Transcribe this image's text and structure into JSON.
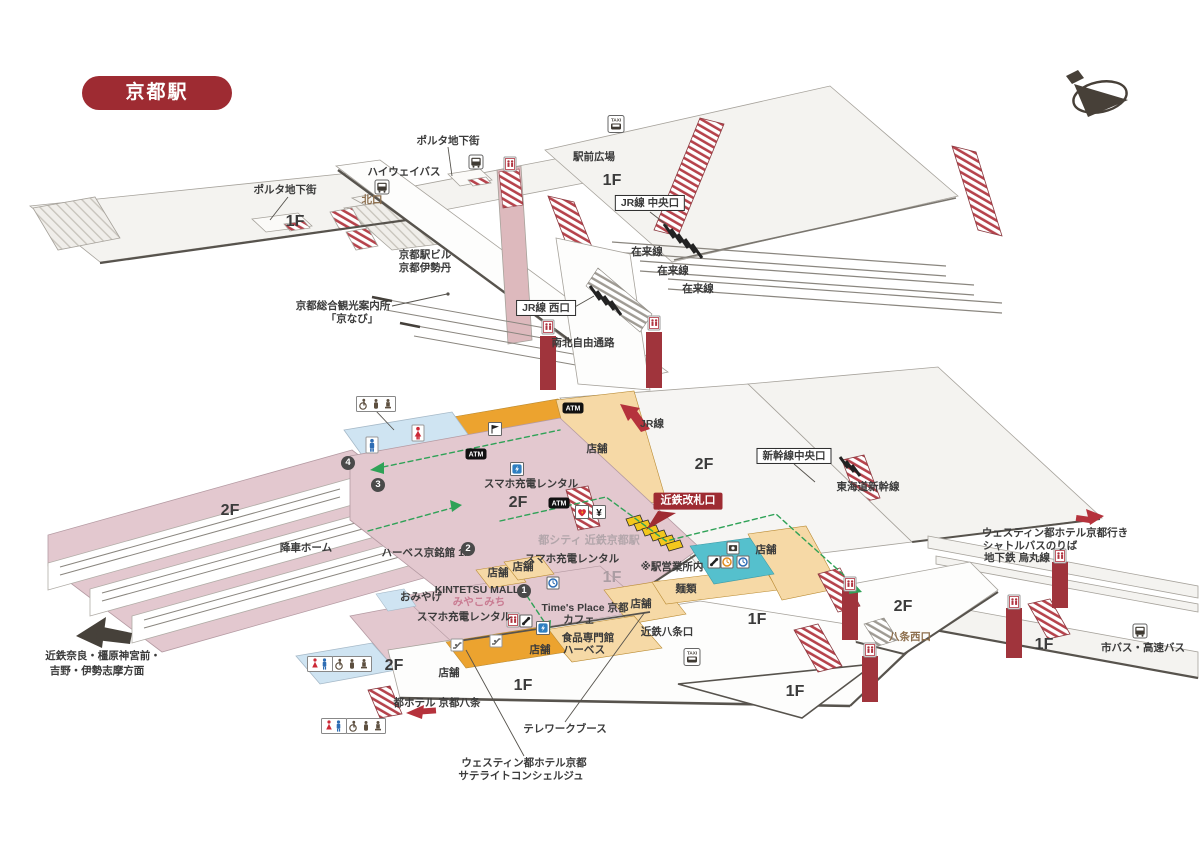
{
  "title_badge": {
    "text": "京都駅"
  },
  "colors": {
    "red": "#9e2b32",
    "pink": "#e3c8cf",
    "orange": "#eca32f",
    "orange_light": "#f6d9a6",
    "blue": "#cfe4f2",
    "teal": "#55c0cd",
    "green": "#2fa257",
    "floor": "#f4f3f0",
    "brown": "#8d6f4e",
    "gray_text": "#b3a6ab",
    "ink": "#3b3b3b"
  },
  "labels": [
    {
      "name": "porta-chikagai-top",
      "text": "ポルタ地下街",
      "x": 448,
      "y": 141,
      "cls": "s"
    },
    {
      "name": "highway-bus",
      "text": "ハイウェイバス",
      "x": 404,
      "y": 172,
      "cls": "s"
    },
    {
      "name": "ekimae-hiroba",
      "text": "駅前広場",
      "x": 594,
      "y": 157,
      "cls": "s"
    },
    {
      "name": "floor-1f-plaza",
      "text": "1F",
      "x": 612,
      "y": 181,
      "cls": "floor"
    },
    {
      "name": "jr-central-exit",
      "text": "JR線 中央口",
      "x": 650,
      "y": 203,
      "cls": "box"
    },
    {
      "name": "kitaguchi",
      "text": "北口",
      "x": 372,
      "y": 200,
      "cls": "brown"
    },
    {
      "name": "porta-chikagai-left",
      "text": "ポルタ地下街",
      "x": 285,
      "y": 190,
      "cls": "s"
    },
    {
      "name": "floor-1f-west",
      "text": "1F",
      "x": 295,
      "y": 222,
      "cls": "floor"
    },
    {
      "name": "kyoto-station-bldg-line1",
      "text": "京都駅ビル",
      "x": 425,
      "y": 255,
      "cls": "s"
    },
    {
      "name": "kyoto-station-bldg-line2",
      "text": "京都伊勢丹",
      "x": 425,
      "y": 268,
      "cls": "s"
    },
    {
      "name": "zairaisen-1",
      "text": "在来線",
      "x": 647,
      "y": 252,
      "cls": "s"
    },
    {
      "name": "zairaisen-2",
      "text": "在来線",
      "x": 673,
      "y": 271,
      "cls": "s"
    },
    {
      "name": "zairaisen-3",
      "text": "在来線",
      "x": 698,
      "y": 289,
      "cls": "s"
    },
    {
      "name": "jr-west-exit",
      "text": "JR線 西口",
      "x": 546,
      "y": 308,
      "cls": "box"
    },
    {
      "name": "kyonavi-line1",
      "text": "京都総合観光案内所",
      "x": 343,
      "y": 306,
      "cls": "s"
    },
    {
      "name": "kyonavi-line2",
      "text": "「京なび」",
      "x": 352,
      "y": 319,
      "cls": "s"
    },
    {
      "name": "free-passage",
      "text": "南北自由通路",
      "x": 583,
      "y": 343,
      "cls": "s"
    },
    {
      "name": "jr-line",
      "text": "JR線",
      "x": 652,
      "y": 424,
      "cls": "s"
    },
    {
      "name": "tenpo-2f",
      "text": "店舗",
      "x": 597,
      "y": 449,
      "cls": "s"
    },
    {
      "name": "floor-2f-jr",
      "text": "2F",
      "x": 704,
      "y": 465,
      "cls": "floor"
    },
    {
      "name": "shinkansen-central-exit",
      "text": "新幹線中央口",
      "x": 794,
      "y": 456,
      "cls": "box"
    },
    {
      "name": "tokaido-shinkansen",
      "text": "東海道新幹線",
      "x": 868,
      "y": 487,
      "cls": "s"
    },
    {
      "name": "sumaho-rental-2f",
      "text": "スマホ充電レンタル",
      "x": 531,
      "y": 484,
      "cls": "s"
    },
    {
      "name": "floor-2f-kintetsu",
      "text": "2F",
      "x": 518,
      "y": 503,
      "cls": "floor"
    },
    {
      "name": "kintetsu-gate-badge",
      "text": "近鉄改札口",
      "x": 688,
      "y": 501,
      "cls": "badge-red"
    },
    {
      "name": "miyako-city-kintetsu",
      "text": "都シティ 近鉄京都駅",
      "x": 589,
      "y": 541,
      "cls": "gray"
    },
    {
      "name": "sumaho-rental-1f-a",
      "text": "スマホ充電レンタル",
      "x": 572,
      "y": 559,
      "cls": "s"
    },
    {
      "name": "eki-eigyosho",
      "text": "※駅営業所内",
      "x": 672,
      "y": 567,
      "cls": "s"
    },
    {
      "name": "tenpo-right",
      "text": "店舗",
      "x": 766,
      "y": 550,
      "cls": "s"
    },
    {
      "name": "kosha-home",
      "text": "降車ホーム",
      "x": 306,
      "y": 548,
      "cls": "s"
    },
    {
      "name": "harves-kyomeikan",
      "text": "ハーベス京銘館 1F",
      "x": 426,
      "y": 553,
      "cls": "s"
    },
    {
      "name": "tenpo-a",
      "text": "店舗",
      "x": 498,
      "y": 573,
      "cls": "s"
    },
    {
      "name": "tenpo-b",
      "text": "店舗",
      "x": 523,
      "y": 567,
      "cls": "s"
    },
    {
      "name": "omiyage",
      "text": "おみやげ",
      "x": 421,
      "y": 597,
      "cls": "s"
    },
    {
      "name": "kintetsu-mall",
      "text": "KINTETSU MALL",
      "x": 477,
      "y": 590,
      "cls": "s"
    },
    {
      "name": "miyakomichi",
      "text": "みやこみち",
      "x": 479,
      "y": 602,
      "cls": "pink-t"
    },
    {
      "name": "sumaho-rental-1f-b",
      "text": "スマホ充電レンタル",
      "x": 464,
      "y": 617,
      "cls": "s"
    },
    {
      "name": "times-place-kyoto",
      "text": "Time's Place 京都",
      "x": 585,
      "y": 608,
      "cls": "s"
    },
    {
      "name": "cafe",
      "text": "カフェ",
      "x": 579,
      "y": 620,
      "cls": "s"
    },
    {
      "name": "food-harves-line1",
      "text": "食品専門館",
      "x": 588,
      "y": 638,
      "cls": "s"
    },
    {
      "name": "food-harves-line2",
      "text": "ハーベス",
      "x": 584,
      "y": 650,
      "cls": "s"
    },
    {
      "name": "tenpo-c",
      "text": "店舗",
      "x": 641,
      "y": 604,
      "cls": "s"
    },
    {
      "name": "tenpo-d",
      "text": "店舗",
      "x": 540,
      "y": 650,
      "cls": "s"
    },
    {
      "name": "tenpo-e",
      "text": "店舗",
      "x": 449,
      "y": 673,
      "cls": "s"
    },
    {
      "name": "menrui",
      "text": "麺類",
      "x": 686,
      "y": 589,
      "cls": "s"
    },
    {
      "name": "kintetsu-hachijo-exit",
      "text": "近鉄八条口",
      "x": 667,
      "y": 632,
      "cls": "s"
    },
    {
      "name": "floor-1f-pink",
      "text": "1F",
      "x": 612,
      "y": 578,
      "cls": "floor-gray"
    },
    {
      "name": "floor-1f-hachijo",
      "text": "1F",
      "x": 757,
      "y": 620,
      "cls": "floor"
    },
    {
      "name": "floor-1f-south",
      "text": "1F",
      "x": 523,
      "y": 686,
      "cls": "floor"
    },
    {
      "name": "floor-1f-triangle",
      "text": "1F",
      "x": 795,
      "y": 692,
      "cls": "floor"
    },
    {
      "name": "floor-1f-east",
      "text": "1F",
      "x": 1044,
      "y": 645,
      "cls": "floor"
    },
    {
      "name": "floor-2f-west-end",
      "text": "2F",
      "x": 394,
      "y": 666,
      "cls": "floor"
    },
    {
      "name": "floor-2f-hachijo-west",
      "text": "2F",
      "x": 903,
      "y": 607,
      "cls": "floor"
    },
    {
      "name": "floor-2f-platform",
      "text": "2F",
      "x": 230,
      "y": 511,
      "cls": "floor"
    },
    {
      "name": "hachijo-west-exit",
      "text": "八条西口",
      "x": 910,
      "y": 637,
      "cls": "brown"
    },
    {
      "name": "westin-shuttle-line1",
      "text": "ウェスティン都ホテル京都行き",
      "x": 1055,
      "y": 533,
      "cls": "s"
    },
    {
      "name": "westin-shuttle-line2",
      "text": "シャトルバスのりば",
      "x": 1030,
      "y": 546,
      "cls": "s"
    },
    {
      "name": "westin-shuttle-line3",
      "text": "地下鉄 烏丸線",
      "x": 1017,
      "y": 558,
      "cls": "s"
    },
    {
      "name": "city-bus",
      "text": "市バス・高速バス",
      "x": 1143,
      "y": 648,
      "cls": "s"
    },
    {
      "name": "kintetsu-nara-line1",
      "text": "近鉄奈良・橿原神宮前・",
      "x": 103,
      "y": 656,
      "cls": "s"
    },
    {
      "name": "kintetsu-nara-line2",
      "text": "吉野・伊勢志摩方面",
      "x": 97,
      "y": 671,
      "cls": "s"
    },
    {
      "name": "miyako-hotel-hachijo",
      "text": "都ホテル 京都八条",
      "x": 437,
      "y": 703,
      "cls": "s"
    },
    {
      "name": "telework-booth",
      "text": "テレワークブース",
      "x": 565,
      "y": 729,
      "cls": "s"
    },
    {
      "name": "westin-satellite-line1",
      "text": "ウェスティン都ホテル京都",
      "x": 524,
      "y": 763,
      "cls": "s"
    },
    {
      "name": "westin-satellite-line2",
      "text": "サテライトコンシェルジュ",
      "x": 521,
      "y": 776,
      "cls": "s"
    }
  ],
  "markers": [
    {
      "name": "marker-4",
      "n": "4",
      "x": 348,
      "y": 463
    },
    {
      "name": "marker-3",
      "n": "3",
      "x": 378,
      "y": 485
    },
    {
      "name": "marker-2",
      "n": "2",
      "x": 468,
      "y": 549
    },
    {
      "name": "marker-1",
      "n": "1",
      "x": 524,
      "y": 591
    }
  ],
  "icons": [
    {
      "name": "taxi-icon-north",
      "type": "taxi",
      "x": 616,
      "y": 124
    },
    {
      "name": "taxi-icon-south",
      "type": "taxi",
      "x": 692,
      "y": 657
    },
    {
      "name": "bus-icon-highway",
      "type": "bus",
      "x": 382,
      "y": 187
    },
    {
      "name": "bus-icon-north",
      "type": "bus",
      "x": 476,
      "y": 162
    },
    {
      "name": "bus-icon-city",
      "type": "bus",
      "x": 1140,
      "y": 631
    },
    {
      "name": "atm-icon-a",
      "type": "atm",
      "x": 573,
      "y": 408
    },
    {
      "name": "atm-icon-b",
      "type": "atm",
      "x": 476,
      "y": 454
    },
    {
      "name": "atm-icon-c",
      "type": "atm",
      "x": 559,
      "y": 503
    },
    {
      "name": "meeting-flag-icon",
      "type": "flag",
      "x": 495,
      "y": 429
    },
    {
      "name": "restroom-male-icon",
      "type": "male",
      "x": 372,
      "y": 445
    },
    {
      "name": "restroom-female-icon",
      "type": "female",
      "x": 418,
      "y": 433
    },
    {
      "name": "accessible-restroom-icon-top",
      "type": "rr3",
      "x": 376,
      "y": 404
    },
    {
      "name": "restroom-mf-icon-west",
      "type": "mf",
      "x": 320,
      "y": 664
    },
    {
      "name": "accessible-restroom-icon-west",
      "type": "rr3",
      "x": 352,
      "y": 664
    },
    {
      "name": "restroom-mf-icon-south",
      "type": "mf",
      "x": 334,
      "y": 726
    },
    {
      "name": "accessible-restroom-icon-south",
      "type": "rr3",
      "x": 366,
      "y": 726
    },
    {
      "name": "elevator-icon-bridge",
      "type": "ev",
      "x": 510,
      "y": 164
    },
    {
      "name": "elevator-icon-passage-w",
      "type": "ev",
      "x": 548,
      "y": 327
    },
    {
      "name": "elevator-icon-passage-e",
      "type": "ev",
      "x": 654,
      "y": 323
    },
    {
      "name": "elevator-icon-hachijo-a",
      "type": "ev",
      "x": 850,
      "y": 584
    },
    {
      "name": "elevator-icon-hachijo-b",
      "type": "ev",
      "x": 870,
      "y": 650
    },
    {
      "name": "elevator-icon-east-a",
      "type": "ev",
      "x": 1014,
      "y": 602
    },
    {
      "name": "elevator-icon-east-b",
      "type": "ev",
      "x": 1060,
      "y": 556
    },
    {
      "name": "elevator-icon-mall",
      "type": "ev",
      "x": 513,
      "y": 620
    },
    {
      "name": "escalator-icon-mall-a",
      "type": "esc",
      "x": 457,
      "y": 645
    },
    {
      "name": "escalator-icon-mall-b",
      "type": "esc",
      "x": 496,
      "y": 641
    },
    {
      "name": "charge-rental-icon-2f",
      "type": "charge",
      "x": 517,
      "y": 469
    },
    {
      "name": "charge-rental-icon-1f",
      "type": "charge",
      "x": 543,
      "y": 628
    },
    {
      "name": "clock-icon-mall",
      "type": "clockb",
      "x": 553,
      "y": 583
    },
    {
      "name": "clock-icon-office-blue",
      "type": "clockb",
      "x": 743,
      "y": 562
    },
    {
      "name": "clock-icon-office-orange",
      "type": "clocko",
      "x": 727,
      "y": 562
    },
    {
      "name": "photo-icon-office",
      "type": "photo",
      "x": 733,
      "y": 548
    },
    {
      "name": "phone-icon-mall",
      "type": "phone",
      "x": 526,
      "y": 621
    },
    {
      "name": "phone-icon-office",
      "type": "phone",
      "x": 714,
      "y": 562
    },
    {
      "name": "aed-heart-icon",
      "type": "heart",
      "x": 582,
      "y": 512
    },
    {
      "name": "currency-exchange-icon",
      "type": "yen",
      "x": 599,
      "y": 512
    }
  ]
}
